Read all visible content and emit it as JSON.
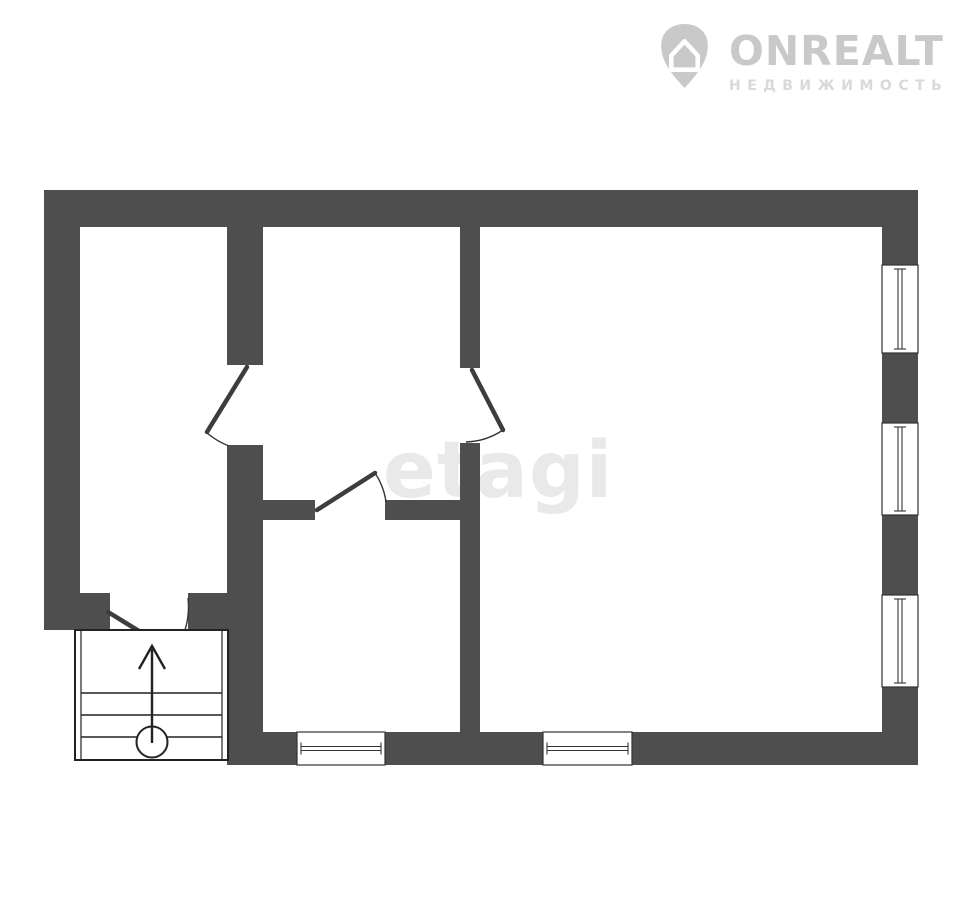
{
  "page": {
    "width": 960,
    "height": 910,
    "background": "#ffffff"
  },
  "branding": {
    "logo_icon": "onrealt-pin-house-icon",
    "logo_title": "ONREALT",
    "logo_subtitle": "НЕДВИЖИМОСТЬ",
    "logo_color": "#c9c9c9",
    "logo_subtitle_color": "#d9d9d9"
  },
  "watermark": {
    "text": "etagi",
    "color": "#e9e9e9"
  },
  "floor_plan": {
    "type": "floor-plan",
    "wall_color": "#4e4e4e",
    "line_color": "#333333",
    "door_leaf_color": "#3d3d3d",
    "stair_line_color": "#222222",
    "walls": [
      [
        44,
        190,
        874,
        37
      ],
      [
        44,
        227,
        36,
        366
      ],
      [
        44,
        593,
        66,
        37
      ],
      [
        188,
        593,
        39,
        37
      ],
      [
        227,
        227,
        36,
        138
      ],
      [
        227,
        445,
        36,
        320
      ],
      [
        460,
        227,
        20,
        141
      ],
      [
        460,
        443,
        20,
        289
      ],
      [
        263,
        500,
        52,
        20
      ],
      [
        385,
        500,
        75,
        20
      ],
      [
        882,
        227,
        36,
        38
      ],
      [
        882,
        353,
        36,
        70
      ],
      [
        882,
        515,
        36,
        80
      ],
      [
        882,
        687,
        36,
        45
      ],
      [
        227,
        732,
        70,
        33
      ],
      [
        385,
        732,
        158,
        33
      ],
      [
        632,
        732,
        286,
        33
      ]
    ],
    "windows": [
      {
        "x": 882,
        "y": 265,
        "w": 36,
        "h": 88,
        "orient": "v"
      },
      {
        "x": 882,
        "y": 423,
        "w": 36,
        "h": 92,
        "orient": "v"
      },
      {
        "x": 882,
        "y": 595,
        "w": 36,
        "h": 92,
        "orient": "v"
      },
      {
        "x": 297,
        "y": 732,
        "w": 88,
        "h": 33,
        "orient": "h"
      },
      {
        "x": 543,
        "y": 732,
        "w": 89,
        "h": 33,
        "orient": "h"
      }
    ],
    "doors": [
      {
        "name": "entry-door",
        "leaf": [
          108,
          612,
          173,
          652
        ],
        "arc": "M188,598 A79 79 0 0 1 175,651"
      },
      {
        "name": "left-room-door",
        "leaf": [
          247,
          367,
          207,
          432
        ],
        "arc": "M207,433 A78 78 0 0 0 229,446"
      },
      {
        "name": "right-room-door",
        "leaf": [
          472,
          370,
          503,
          430
        ],
        "arc": "M503,430 A70 70 0 0 1 466,442"
      },
      {
        "name": "middle-room-door",
        "leaf": [
          317,
          510,
          375,
          473
        ],
        "arc": "M375,473 A69 69 0 0 1 386,502"
      }
    ],
    "stairs": {
      "outer": [
        75,
        630,
        153,
        130
      ],
      "inner_x": [
        81,
        222
      ],
      "tread_y": [
        693,
        715,
        737
      ],
      "arrow_shaft": [
        152,
        743,
        152,
        649
      ],
      "arrow_head": [
        [
          139,
          669
        ],
        [
          152,
          646
        ],
        [
          165,
          669
        ]
      ],
      "circle": [
        152,
        742,
        15.5
      ]
    }
  }
}
